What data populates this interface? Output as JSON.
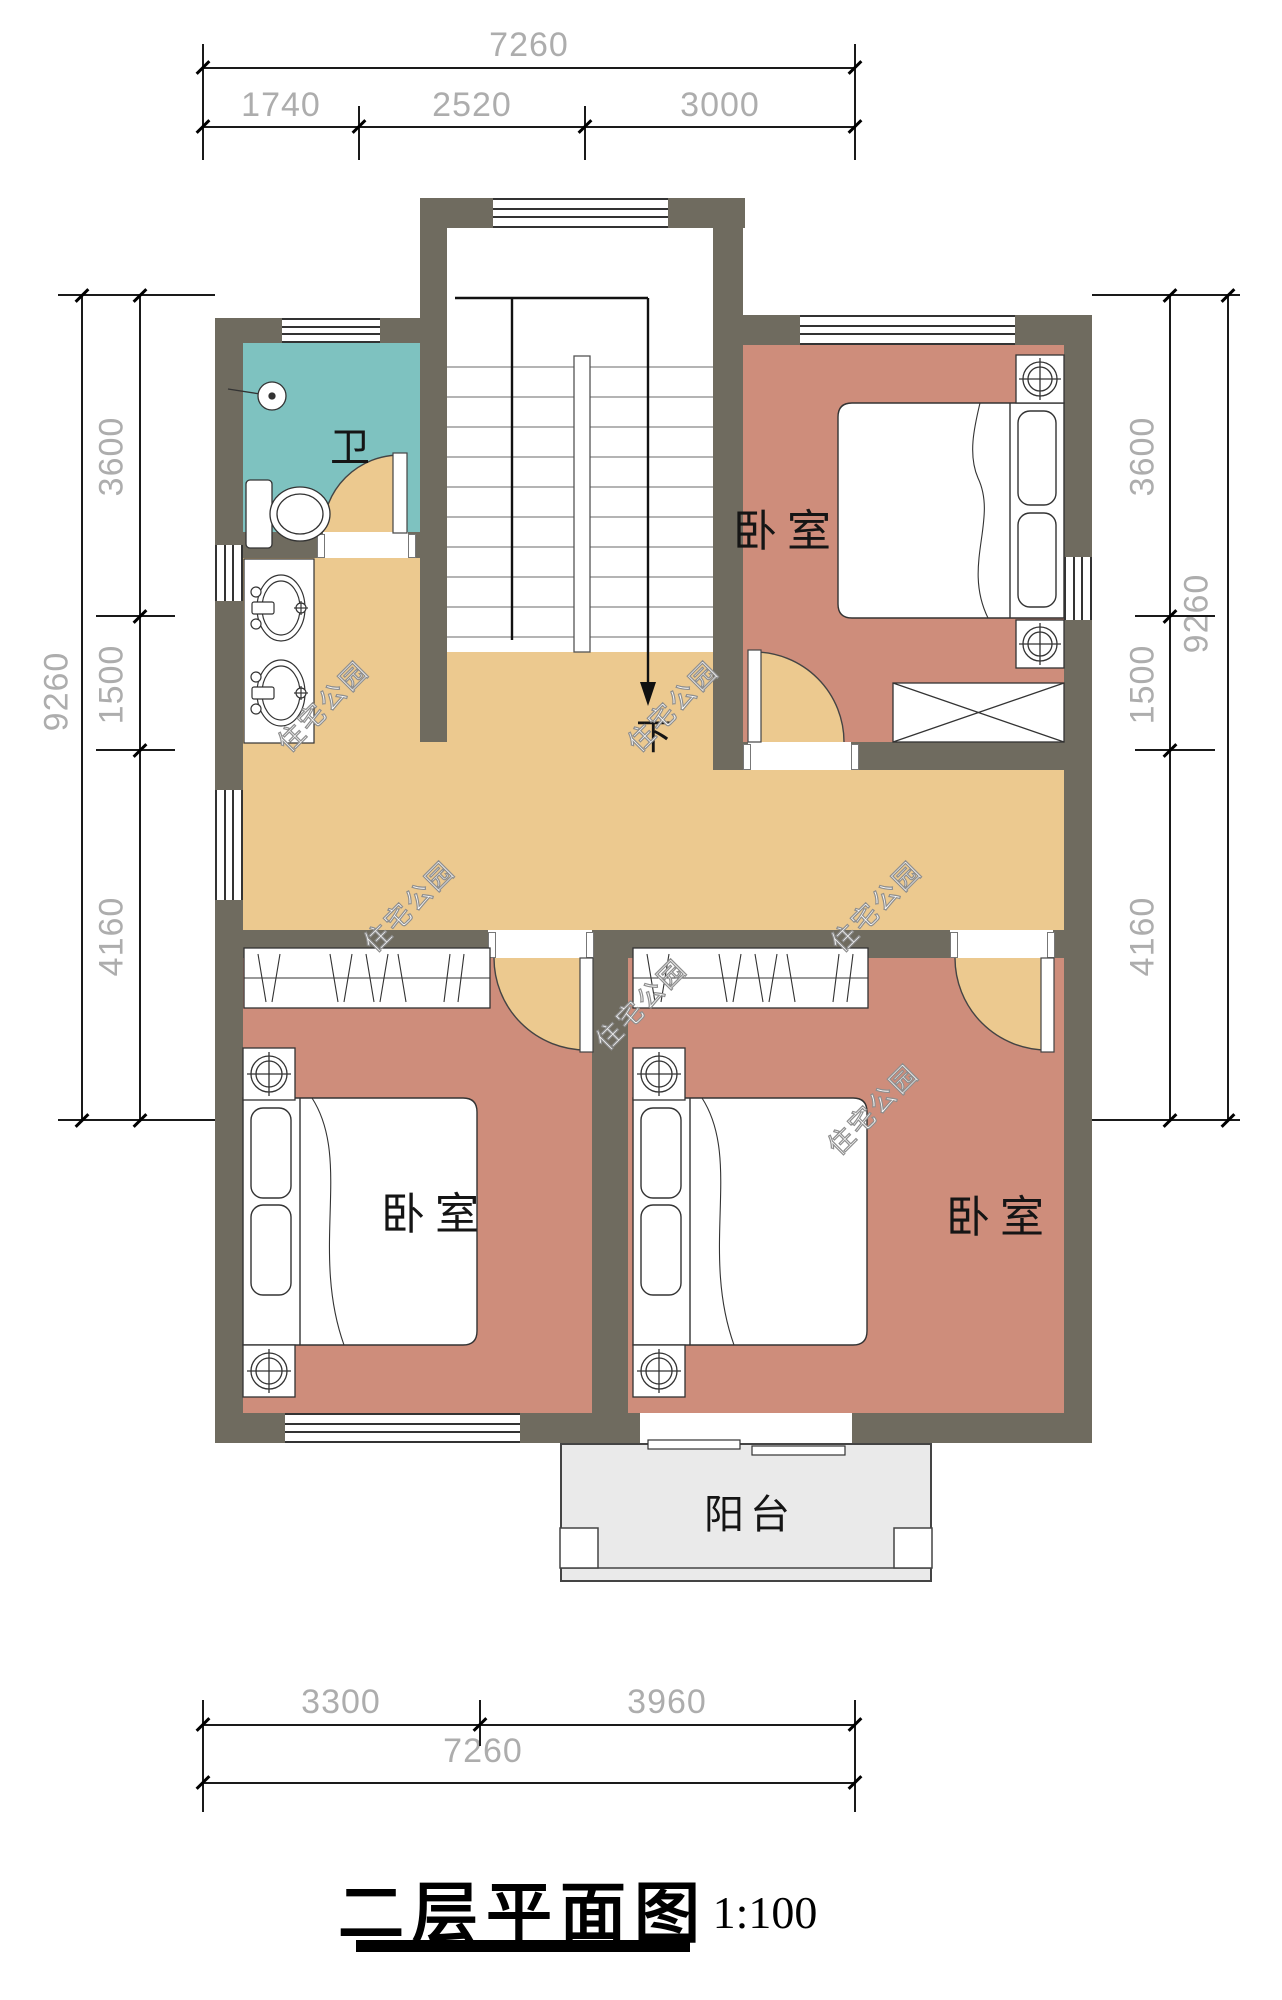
{
  "title": {
    "text": "二层平面图",
    "scale": "1:100"
  },
  "labels": {
    "bathroom": "卫",
    "bedroom_top_right": "卧室",
    "bedroom_bottom_left": "卧室",
    "bedroom_bottom_right": "卧室",
    "balcony": "阳台",
    "stairs_down": "下"
  },
  "watermark": {
    "text": "住宅公园"
  },
  "dimensions": {
    "top": {
      "total": "7260",
      "segments": [
        "1740",
        "2520",
        "3000"
      ]
    },
    "bottom": {
      "total": "7260",
      "segments": [
        "3300",
        "3960"
      ]
    },
    "left": {
      "total": "9260",
      "segments": [
        "3600",
        "1500",
        "4160"
      ]
    },
    "right": {
      "total": "9260",
      "segments": [
        "3600",
        "1500",
        "4160"
      ]
    }
  },
  "colors": {
    "wall": "#6F6B5F",
    "bedroom_floor": "#CE8D7B",
    "corridor_floor": "#ECC98F",
    "bathroom_floor": "#7EC2C0",
    "balcony_floor": "#EAEAEA",
    "dimension_text": "#ADADAD"
  }
}
